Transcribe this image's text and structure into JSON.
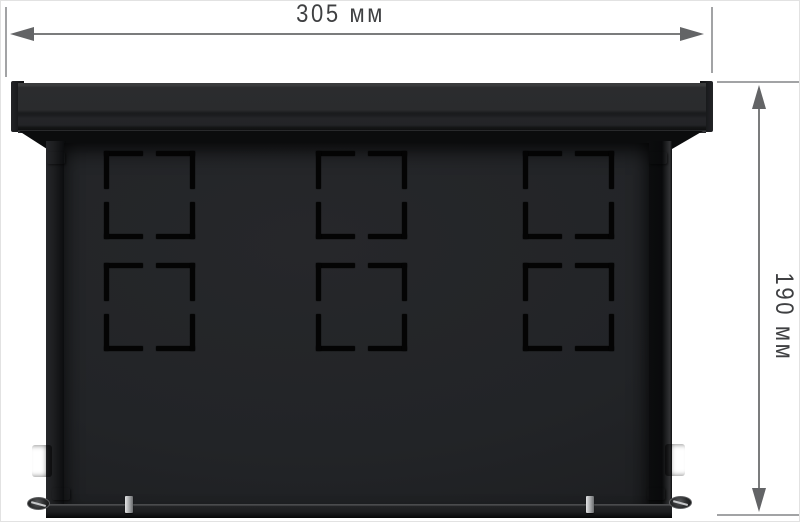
{
  "drawing": {
    "title": "Dimensional drawing of a black metal wall-mount enclosure (rear view)",
    "dimensions": {
      "width_label": "305 мм",
      "width_value_mm": 305,
      "height_label": "190 мм",
      "height_value_mm": 190,
      "unit": "мм"
    },
    "knockouts": {
      "rows": 2,
      "cols": 3
    },
    "colors": {
      "background": "#ffffff",
      "enclosure_body": "#232528",
      "enclosure_lid": "#2a2b2d",
      "knockout_slot": "#040404",
      "dimension_line": "#7b7c7d",
      "extension_line": "#a2a3a5",
      "arrowhead": "#636466",
      "dimension_text": "#3f4042",
      "metal_fixture": "#c9cbcd"
    }
  }
}
